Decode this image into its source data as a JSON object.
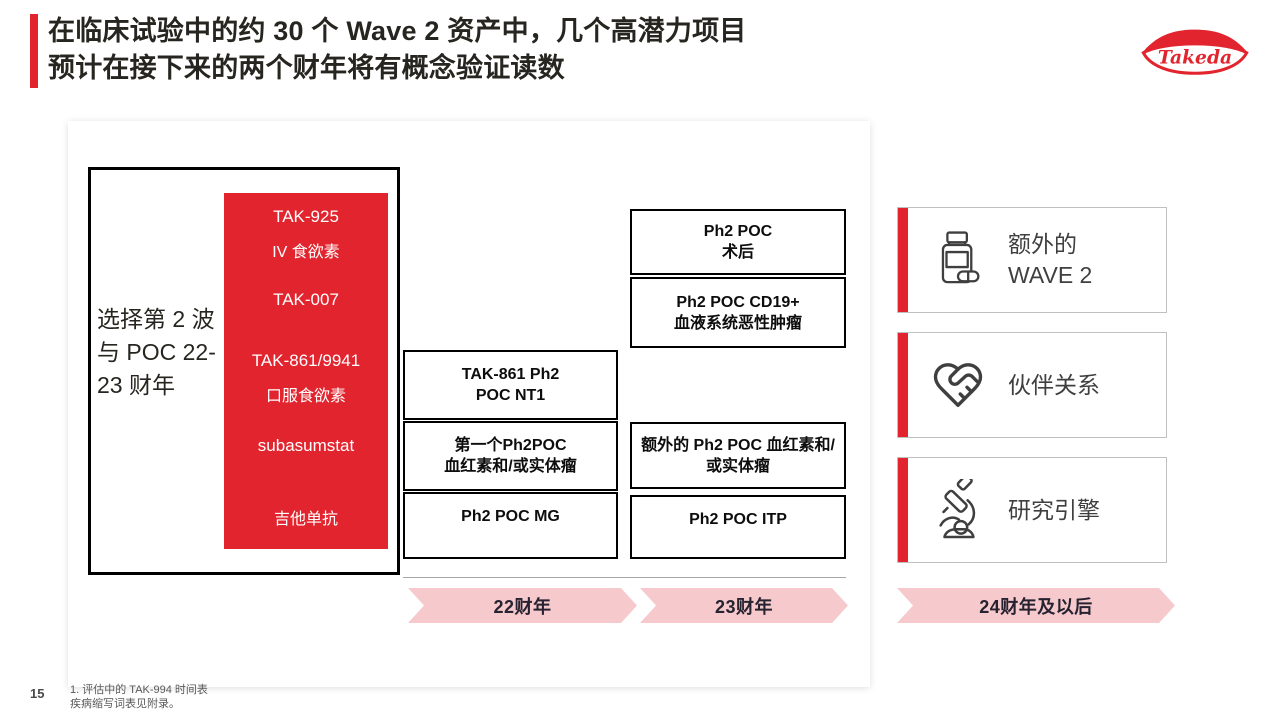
{
  "header": {
    "title_line1": "在临床试验中的约 30 个 Wave 2 资产中，几个高潜力项目",
    "title_line2": "预计在接下来的两个财年将有概念验证读数",
    "logo_text": "Takeda"
  },
  "selection": {
    "label_line1": "选择第 2 波",
    "label_line2": "与 POC 22-",
    "label_line3": "23 财年",
    "assets": [
      "TAK-925",
      "IV 食欲素",
      "TAK-007",
      "TAK-861/9941",
      "口服食欲素",
      "subasumstat",
      "吉他单抗"
    ]
  },
  "fy22": {
    "boxes": [
      {
        "line1": "TAK-861 Ph2",
        "line2": "POC NT1"
      },
      {
        "line1": "第一个Ph2POC",
        "line2": "血红素和/或实体瘤"
      },
      {
        "line1": "Ph2 POC MG",
        "line2": ""
      }
    ]
  },
  "fy23": {
    "boxes": [
      {
        "line1": "Ph2 POC",
        "line2": "术后"
      },
      {
        "line1": "Ph2 POC CD19+",
        "line2": "血液系统恶性肿瘤"
      },
      {
        "line1": "额外的 Ph2 POC 血红素和/",
        "line2": "或实体瘤"
      },
      {
        "line1": "Ph2 POC ITP",
        "line2": ""
      }
    ]
  },
  "timeline": {
    "fy22_label": "22财年",
    "fy23_label": "23财年",
    "fy24_label": "24财年及以后"
  },
  "future_cards": [
    {
      "icon": "pill-bottle-icon",
      "line1": "额外的",
      "line2": "WAVE 2"
    },
    {
      "icon": "handshake-heart-icon",
      "line1": "伙伴关系",
      "line2": ""
    },
    {
      "icon": "microscope-icon",
      "line1": "研究引擎",
      "line2": ""
    }
  ],
  "footer": {
    "page_number": "15",
    "footnote_line1": "1. 评估中的 TAK-994 时间表",
    "footnote_line2": "疾病缩写词表见附录。"
  },
  "colors": {
    "takeda_red": "#e2242e",
    "chevron_pink": "#f6c9cd",
    "text_dark": "#27251f"
  }
}
